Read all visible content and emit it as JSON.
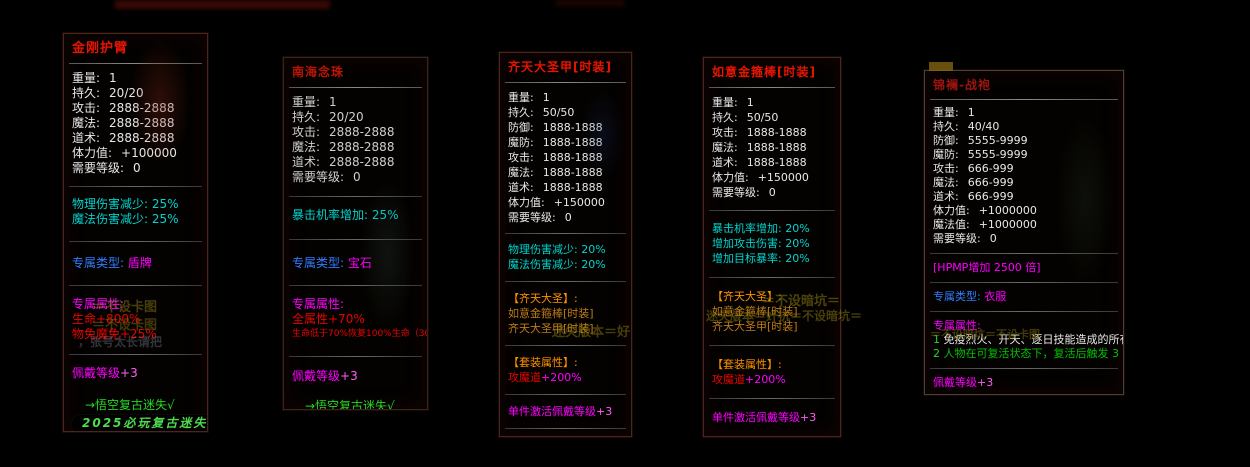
{
  "canvas": {
    "width": 1250,
    "height": 467,
    "background": "#000000"
  },
  "palette": {
    "titleRed": "#e81400",
    "titleRedDim": "#bb1405",
    "titleRedDark": "#9a1410",
    "white": "#e8e8e8",
    "whiteDim": "#cfcfcf",
    "cyan": "#00d4ce",
    "blue": "#2f7dff",
    "magenta": "#ff00ff",
    "magentaBright": "#ff5ef0",
    "red": "#e60400",
    "orange": "#ff9200",
    "orangeDim": "#c07c16",
    "green": "#00c000",
    "greenBright": "#22d822",
    "pillGreen": "#4edc4e",
    "watermarkOlive": "#8a7a14",
    "watermarkBlue": "#8a9ab4"
  },
  "panels": [
    {
      "slug": "jingang-hubi",
      "geometry": {
        "left": 63,
        "top": 33,
        "width": 145,
        "height": 399
      },
      "density": "",
      "lines": [
        {
          "type": "title",
          "text": "金刚护臂",
          "color": "titleRed"
        },
        {
          "type": "divider",
          "bright": true
        },
        {
          "type": "gap",
          "h": 4
        },
        {
          "type": "stat",
          "label": "重量:",
          "value": "1"
        },
        {
          "type": "stat",
          "label": "持久:",
          "value": "20/20"
        },
        {
          "type": "stat",
          "label": "攻击:",
          "value": "2888-2888"
        },
        {
          "type": "stat",
          "label": "魔法:",
          "value": "2888-2888"
        },
        {
          "type": "stat",
          "label": "道术:",
          "value": "2888-2888"
        },
        {
          "type": "stat",
          "label": "体力值:",
          "value": "+100000"
        },
        {
          "type": "stat",
          "label": "需要等级:",
          "value": "0"
        },
        {
          "type": "gap",
          "h": 7
        },
        {
          "type": "divider"
        },
        {
          "type": "gap",
          "h": 7
        },
        {
          "type": "line",
          "text": "物理伤害减少: 25%",
          "color": "cyan"
        },
        {
          "type": "line",
          "text": "魔法伤害减少: 25%",
          "color": "cyan"
        },
        {
          "type": "gap",
          "h": 11
        },
        {
          "type": "divider"
        },
        {
          "type": "gap",
          "h": 11
        },
        {
          "type": "pair",
          "a": "专属类型: ",
          "ac": "blue",
          "b": "盾牌",
          "bc": "magenta"
        },
        {
          "type": "gap",
          "h": 11
        },
        {
          "type": "divider"
        },
        {
          "type": "gap",
          "h": 8
        },
        {
          "type": "line",
          "text": "专属属性:",
          "color": "magenta"
        },
        {
          "type": "line",
          "text": "生命+800%",
          "color": "red"
        },
        {
          "type": "line",
          "text": "物免魔免+25%",
          "color": "red"
        },
        {
          "type": "gap",
          "h": 9
        },
        {
          "type": "divider"
        },
        {
          "type": "gap",
          "h": 8
        },
        {
          "type": "pair",
          "a": "佩戴等级",
          "ac": "magenta",
          "b": "+3",
          "bc": "magentaBright"
        },
        {
          "type": "gap",
          "h": 17
        },
        {
          "type": "line",
          "text": "→悟空复古迷失√",
          "color": "greenBright",
          "name": "signature-line",
          "indent": true
        },
        {
          "type": "pill",
          "text": "2025必玩复古迷失 ←",
          "color": "pillGreen"
        }
      ]
    },
    {
      "slug": "nanhai-nianzhu",
      "geometry": {
        "left": 283,
        "top": 57,
        "width": 145,
        "height": 353
      },
      "density": "dim",
      "lines": [
        {
          "type": "title",
          "text": "南海念珠",
          "color": "titleRedDim"
        },
        {
          "type": "divider",
          "bright": true
        },
        {
          "type": "gap",
          "h": 4
        },
        {
          "type": "stat",
          "label": "重量:",
          "value": "1",
          "color": "whiteDim"
        },
        {
          "type": "stat",
          "label": "持久:",
          "value": "20/20",
          "color": "whiteDim"
        },
        {
          "type": "stat",
          "label": "攻击:",
          "value": "2888-2888",
          "color": "whiteDim"
        },
        {
          "type": "stat",
          "label": "魔法:",
          "value": "2888-2888",
          "color": "whiteDim"
        },
        {
          "type": "stat",
          "label": "道术:",
          "value": "2888-2888",
          "color": "whiteDim"
        },
        {
          "type": "stat",
          "label": "需要等级:",
          "value": "0",
          "color": "whiteDim"
        },
        {
          "type": "gap",
          "h": 8
        },
        {
          "type": "divider"
        },
        {
          "type": "gap",
          "h": 8
        },
        {
          "type": "line",
          "text": "暴击机率增加: 25%",
          "color": "cyan"
        },
        {
          "type": "gap",
          "h": 13
        },
        {
          "type": "divider"
        },
        {
          "type": "gap",
          "h": 13
        },
        {
          "type": "pair",
          "a": "专属类型: ",
          "ac": "blue",
          "b": "宝石",
          "bc": "magenta"
        },
        {
          "type": "gap",
          "h": 11
        },
        {
          "type": "divider"
        },
        {
          "type": "gap",
          "h": 8
        },
        {
          "type": "line",
          "text": "专属属性:",
          "color": "magenta"
        },
        {
          "type": "line",
          "text": "全属性+70%",
          "color": "red"
        },
        {
          "type": "line",
          "text": "生命低于70%恢复100%生命（300秒CD）",
          "color": "red",
          "size": "small"
        },
        {
          "type": "gap",
          "h": 11
        },
        {
          "type": "divider"
        },
        {
          "type": "gap",
          "h": 9
        },
        {
          "type": "pair",
          "a": "佩戴等级",
          "ac": "magenta",
          "b": "+3",
          "bc": "magentaBright"
        },
        {
          "type": "gap",
          "h": 15
        },
        {
          "type": "line",
          "text": "→悟空复古迷失√",
          "color": "greenBright",
          "name": "signature-line",
          "indent": true
        },
        {
          "type": "pill",
          "text": "2025必玩复古迷失 ←",
          "color": "pillGreen"
        }
      ]
    },
    {
      "slug": "qitian-dasheng-jia",
      "geometry": {
        "left": 499,
        "top": 52,
        "width": 133,
        "height": 385
      },
      "density": "mid",
      "lines": [
        {
          "type": "title",
          "text": "齐天大圣甲[时装]",
          "color": "titleRed"
        },
        {
          "type": "divider",
          "bright": true
        },
        {
          "type": "gap",
          "h": 4
        },
        {
          "type": "stat",
          "label": "重量:",
          "value": "1"
        },
        {
          "type": "stat",
          "label": "持久:",
          "value": "50/50"
        },
        {
          "type": "stat",
          "label": "防御:",
          "value": "1888-1888"
        },
        {
          "type": "stat",
          "label": "魔防:",
          "value": "1888-1888"
        },
        {
          "type": "stat",
          "label": "攻击:",
          "value": "1888-1888"
        },
        {
          "type": "stat",
          "label": "魔法:",
          "value": "1888-1888"
        },
        {
          "type": "stat",
          "label": "道术:",
          "value": "1888-1888"
        },
        {
          "type": "stat",
          "label": "体力值:",
          "value": "+150000"
        },
        {
          "type": "stat",
          "label": "需要等级:",
          "value": "0"
        },
        {
          "type": "gap",
          "h": 5
        },
        {
          "type": "divider"
        },
        {
          "type": "gap",
          "h": 5
        },
        {
          "type": "line",
          "text": "物理伤害减少: 20%",
          "color": "cyan"
        },
        {
          "type": "line",
          "text": "魔法伤害减少: 20%",
          "color": "cyan"
        },
        {
          "type": "gap",
          "h": 6
        },
        {
          "type": "divider"
        },
        {
          "type": "gap",
          "h": 6
        },
        {
          "type": "line",
          "text": "【齐天大圣】:",
          "color": "orange",
          "name": "set-name"
        },
        {
          "type": "line",
          "text": "如意金箍棒[时装]",
          "color": "orangeDim",
          "name": "set-item"
        },
        {
          "type": "line",
          "text": "齐天大圣甲[时装]",
          "color": "orangeDim",
          "name": "set-item"
        },
        {
          "type": "gap",
          "h": 6
        },
        {
          "type": "divider"
        },
        {
          "type": "gap",
          "h": 6
        },
        {
          "type": "line",
          "text": "【套装属性】:",
          "color": "orange",
          "name": "set-bonus-header"
        },
        {
          "type": "pair",
          "a": "攻魔道",
          "ac": "red",
          "b": "+200%",
          "bc": "magenta"
        },
        {
          "type": "gap",
          "h": 6
        },
        {
          "type": "divider"
        },
        {
          "type": "gap",
          "h": 6
        },
        {
          "type": "pair",
          "a": "单件激活佩戴等级",
          "ac": "magenta",
          "b": "+3",
          "bc": "magentaBright"
        },
        {
          "type": "gap",
          "h": 6
        },
        {
          "type": "divider"
        },
        {
          "type": "gap",
          "h": 6
        },
        {
          "type": "line",
          "text": "[悟空复古迷失·独家迷失]",
          "color": "green",
          "name": "signature-line"
        },
        {
          "type": "line",
          "text": "[只为打造长期迷失品牌]",
          "color": "green",
          "name": "signature-line"
        }
      ]
    },
    {
      "slug": "ruyi-jingubang",
      "geometry": {
        "left": 703,
        "top": 57,
        "width": 138,
        "height": 380
      },
      "density": "mid",
      "lines": [
        {
          "type": "title",
          "text": "如意金箍棒[时装]",
          "color": "titleRed"
        },
        {
          "type": "divider",
          "bright": true
        },
        {
          "type": "gap",
          "h": 4
        },
        {
          "type": "stat",
          "label": "重量:",
          "value": "1"
        },
        {
          "type": "stat",
          "label": "持久:",
          "value": "50/50"
        },
        {
          "type": "stat",
          "label": "攻击:",
          "value": "1888-1888"
        },
        {
          "type": "stat",
          "label": "魔法:",
          "value": "1888-1888"
        },
        {
          "type": "stat",
          "label": "道术:",
          "value": "1888-1888"
        },
        {
          "type": "stat",
          "label": "体力值:",
          "value": "+150000"
        },
        {
          "type": "stat",
          "label": "需要等级:",
          "value": "0"
        },
        {
          "type": "gap",
          "h": 7
        },
        {
          "type": "divider"
        },
        {
          "type": "gap",
          "h": 7
        },
        {
          "type": "line",
          "text": "暴击机率增加: 20%",
          "color": "cyan"
        },
        {
          "type": "line",
          "text": "增加攻击伤害: 20%",
          "color": "cyan"
        },
        {
          "type": "line",
          "text": "增加目标暴率: 20%",
          "color": "cyan"
        },
        {
          "type": "gap",
          "h": 8
        },
        {
          "type": "divider"
        },
        {
          "type": "gap",
          "h": 8
        },
        {
          "type": "line",
          "text": "【齐天大圣】:",
          "color": "orange",
          "name": "set-name"
        },
        {
          "type": "line",
          "text": "如意金箍棒[时装]",
          "color": "orangeDim",
          "name": "set-item"
        },
        {
          "type": "line",
          "text": "齐天大圣甲[时装]",
          "color": "orangeDim",
          "name": "set-item"
        },
        {
          "type": "gap",
          "h": 8
        },
        {
          "type": "divider"
        },
        {
          "type": "gap",
          "h": 8
        },
        {
          "type": "line",
          "text": "【套装属性】:",
          "color": "orange",
          "name": "set-bonus-header"
        },
        {
          "type": "pair",
          "a": "攻魔道",
          "ac": "red",
          "b": "+200%",
          "bc": "magenta"
        },
        {
          "type": "gap",
          "h": 8
        },
        {
          "type": "divider"
        },
        {
          "type": "gap",
          "h": 8
        },
        {
          "type": "pair",
          "a": "单件激活佩戴等级",
          "ac": "magenta",
          "b": "+3",
          "bc": "magentaBright"
        },
        {
          "type": "gap",
          "h": 8
        },
        {
          "type": "divider"
        },
        {
          "type": "gap",
          "h": 8
        },
        {
          "type": "line",
          "text": "[悟空复古迷失·独家迷失]",
          "color": "green",
          "name": "signature-line"
        },
        {
          "type": "line",
          "text": "[只为打造长期迷失品牌]",
          "color": "green",
          "name": "signature-line"
        }
      ]
    },
    {
      "slug": "jinlan-zhanpao",
      "geometry": {
        "left": 924,
        "top": 70,
        "width": 200,
        "height": 325
      },
      "density": "cmp",
      "lines": [
        {
          "type": "title",
          "text": "锦襕-战袍",
          "color": "titleRedDark"
        },
        {
          "type": "divider",
          "bright": true
        },
        {
          "type": "gap",
          "h": 3
        },
        {
          "type": "stat",
          "label": "重量:",
          "value": "1"
        },
        {
          "type": "stat",
          "label": "持久:",
          "value": "40/40"
        },
        {
          "type": "stat",
          "label": "防御:",
          "value": "5555-9999"
        },
        {
          "type": "stat",
          "label": "魔防:",
          "value": "5555-9999"
        },
        {
          "type": "stat",
          "label": "攻击:",
          "value": "666-999"
        },
        {
          "type": "stat",
          "label": "魔法:",
          "value": "666-999"
        },
        {
          "type": "stat",
          "label": "道术:",
          "value": "666-999"
        },
        {
          "type": "stat",
          "label": "体力值:",
          "value": "+1000000"
        },
        {
          "type": "stat",
          "label": "魔法值:",
          "value": "+1000000"
        },
        {
          "type": "stat",
          "label": "需要等级:",
          "value": "0"
        },
        {
          "type": "gap",
          "h": 4
        },
        {
          "type": "divider"
        },
        {
          "type": "gap",
          "h": 4
        },
        {
          "type": "line",
          "text": "[HPMP增加 2500 倍]",
          "color": "magenta"
        },
        {
          "type": "gap",
          "h": 4
        },
        {
          "type": "divider"
        },
        {
          "type": "gap",
          "h": 4
        },
        {
          "type": "pair",
          "a": "专属类型: ",
          "ac": "blue",
          "b": "衣服",
          "bc": "magenta"
        },
        {
          "type": "gap",
          "h": 4
        },
        {
          "type": "divider"
        },
        {
          "type": "gap",
          "h": 4
        },
        {
          "type": "line",
          "text": "专属属性:",
          "color": "magenta"
        },
        {
          "type": "pair",
          "a": "1 ",
          "ac": "greenBright",
          "b": "免疫烈火、开天、逐日技能造成的所有伤害",
          "bc": "white"
        },
        {
          "type": "pair",
          "a": "2 ",
          "ac": "greenBright",
          "b": "人物在可复活状态下，复活后触发 3 秒无敌",
          "bc": "green"
        },
        {
          "type": "gap",
          "h": 4
        },
        {
          "type": "divider"
        },
        {
          "type": "gap",
          "h": 4
        },
        {
          "type": "pair",
          "a": "佩戴等级",
          "ac": "magenta",
          "b": "+3",
          "bc": "magentaBright"
        },
        {
          "type": "gap",
          "h": 8
        },
        {
          "type": "line",
          "text": "→悟空复古迷失√",
          "color": "greenBright",
          "name": "signature-line",
          "indent": true
        },
        {
          "type": "pill",
          "text": "2025必玩复古迷失 ←",
          "color": "pillGreen"
        }
      ]
    }
  ],
  "watermarks": [
    {
      "text": "＝不设卡图",
      "left": 92,
      "top": 296,
      "color": "watermarkOlive",
      "opacity": 0.5,
      "size": 13
    },
    {
      "text": "＝不设卡图",
      "left": 92,
      "top": 314,
      "color": "watermarkOlive",
      "opacity": 0.45,
      "size": 13
    },
    {
      "text": "，张号太长请把",
      "left": 78,
      "top": 333,
      "color": "watermarkBlue",
      "opacity": 0.32,
      "size": 12
    },
    {
      "text": "迷失版本＝好",
      "left": 552,
      "top": 321,
      "color": "watermarkOlive",
      "opacity": 0.5,
      "size": 13
    },
    {
      "text": "＝不设暗坑＝",
      "left": 762,
      "top": 290,
      "color": "watermarkOlive",
      "opacity": 0.55,
      "size": 13
    },
    {
      "text": "迷失版本＝奸抗＝不设暗坑＝",
      "left": 706,
      "top": 307,
      "color": "watermarkOlive",
      "opacity": 0.5,
      "size": 12
    },
    {
      "text": "＝不设暗坑＝不设卡图",
      "left": 930,
      "top": 326,
      "color": "watermarkOlive",
      "opacity": 0.45,
      "size": 11
    }
  ]
}
